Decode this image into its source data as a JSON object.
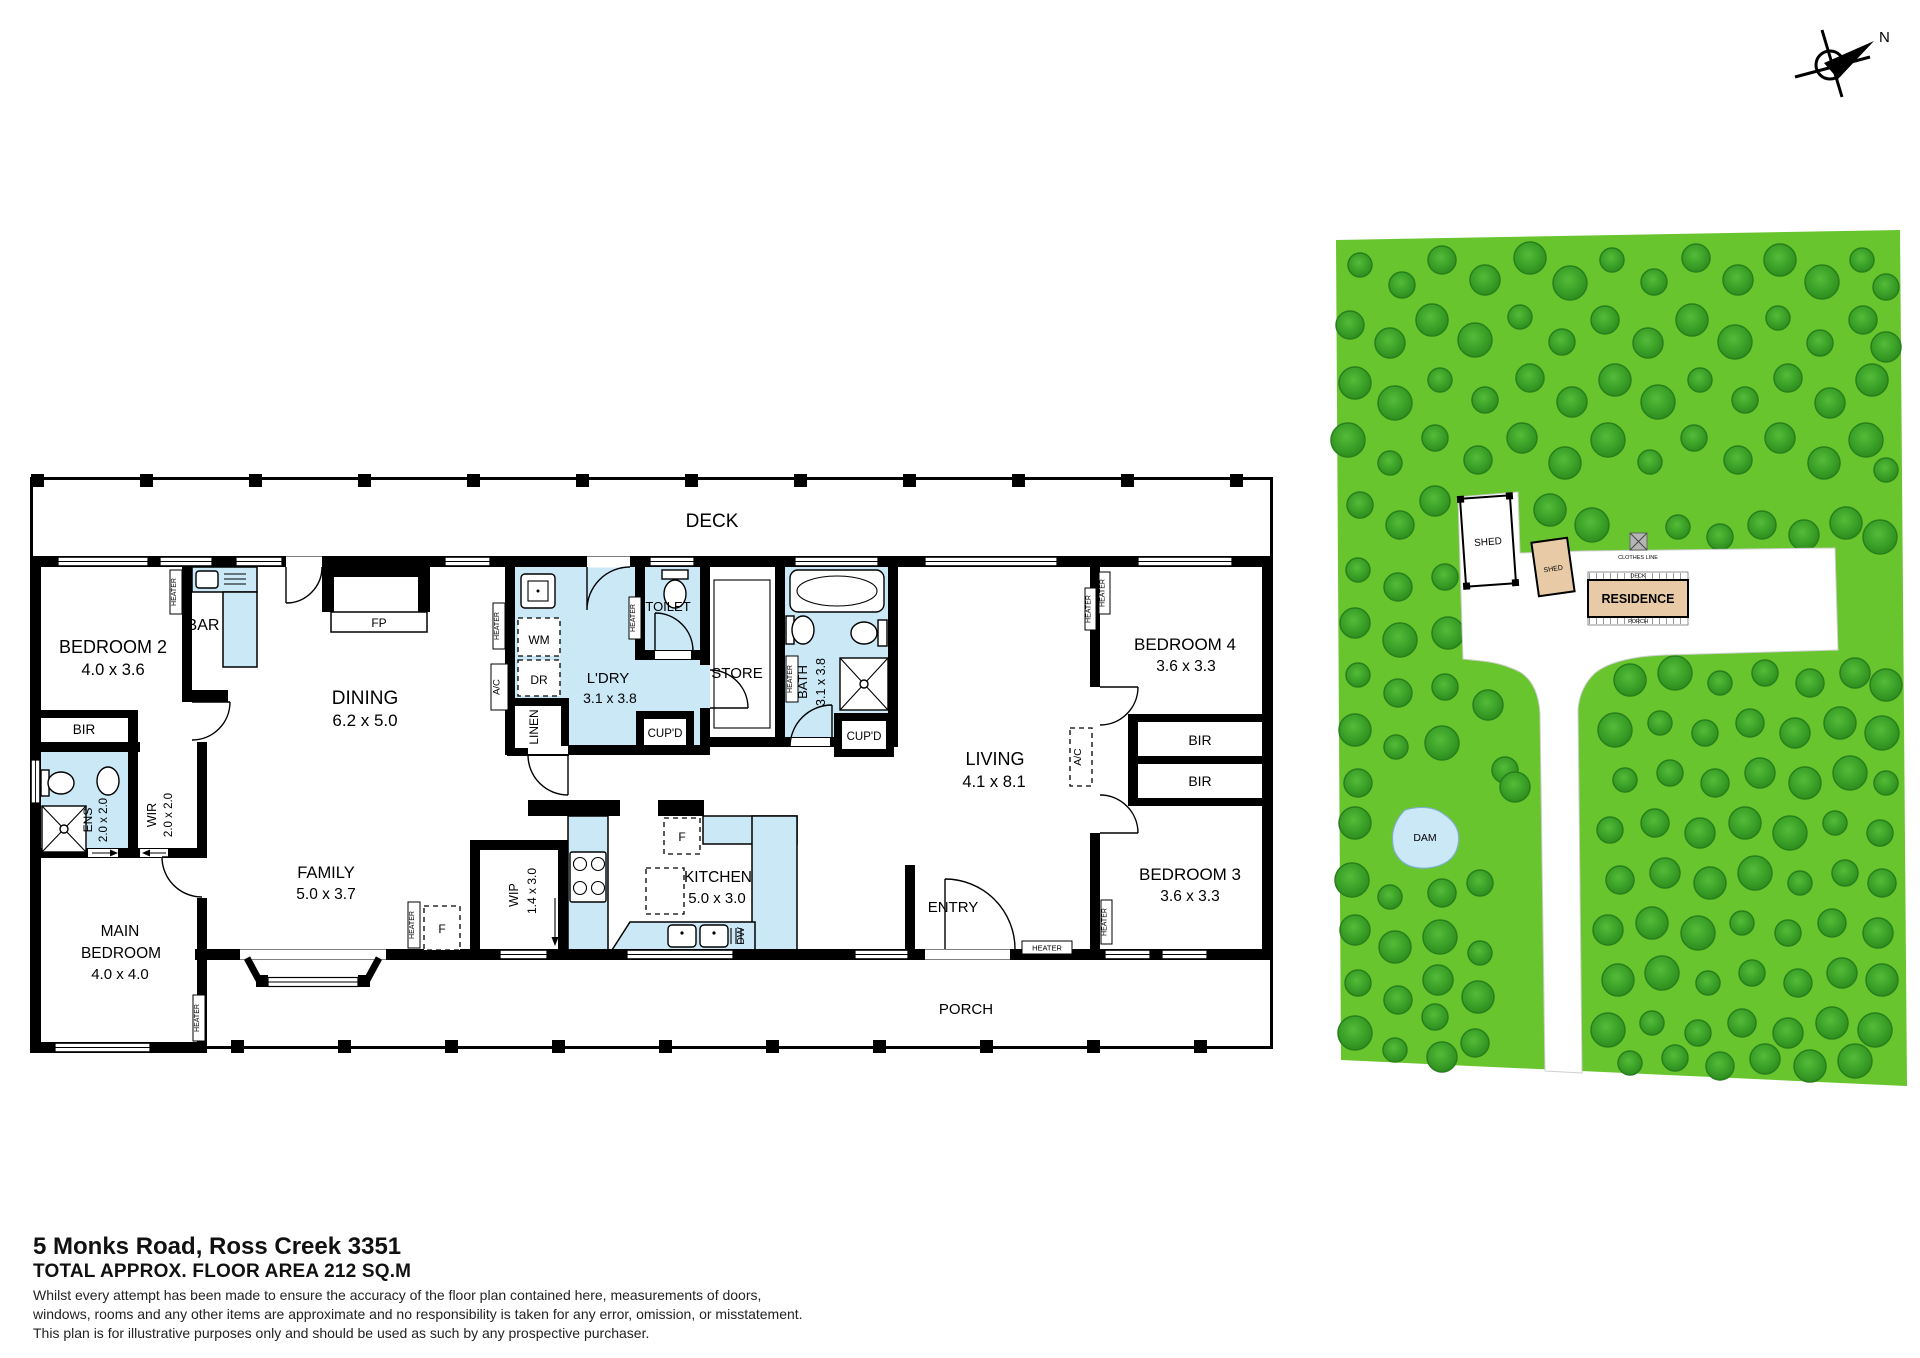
{
  "title_block": {
    "address": "5 Monks Road, Ross Creek 3351",
    "floor_area": "TOTAL APPROX. FLOOR AREA 212 SQ.M",
    "disclaimer_lines": [
      "Whilst every attempt has been made to ensure the accuracy of the floor plan contained here, measurements of doors,",
      "windows, rooms and any other items are approximate and no responsibility is taken for any error, omission, or misstatement.",
      "This plan is for illustrative purposes only and should be used as such by any prospective purchaser."
    ]
  },
  "compass": {
    "north_label": "N"
  },
  "floor_plan": {
    "deck": "DECK",
    "porch": "PORCH",
    "entry": "ENTRY",
    "bedroom2": {
      "name": "BEDROOM 2",
      "dims": "4.0 x 3.6"
    },
    "bar": "BAR",
    "dining": {
      "name": "DINING",
      "dims": "6.2 x 5.0"
    },
    "fireplace": "FP",
    "laundry": {
      "name": "L'DRY",
      "dims": "3.1 x 3.8"
    },
    "toilet": "TOILET",
    "store": "STORE",
    "bath": {
      "name": "BATH",
      "dims": "3.1 x 3.8"
    },
    "living": {
      "name": "LIVING",
      "dims": "4.1 x 8.1"
    },
    "bedroom4": {
      "name": "BEDROOM 4",
      "dims": "3.6 x 3.3"
    },
    "bedroom3": {
      "name": "BEDROOM 3",
      "dims": "3.6 x 3.3"
    },
    "main_bedroom": {
      "line1": "MAIN",
      "line2": "BEDROOM",
      "dims": "4.0 x 4.0"
    },
    "family": {
      "name": "FAMILY",
      "dims": "5.0 x 3.7"
    },
    "kitchen": {
      "name": "KITCHEN",
      "dims": "5.0 x 3.0"
    },
    "wip": {
      "name": "WIP",
      "dims": "1.4 x 3.0"
    },
    "ens": {
      "name": "ENS",
      "dims": "2.0 x 2.0"
    },
    "wir": {
      "name": "WIR",
      "dims": "2.0 x 2.0"
    },
    "bir": "BIR",
    "cupboard": "CUP'D",
    "linen": "LINEN",
    "heater": "HEATER",
    "ac": "A/C",
    "wm": "WM",
    "dr": "DR",
    "fridge": "F",
    "dw": "DW"
  },
  "site_plan": {
    "shed": "SHED",
    "residence": "RESIDENCE",
    "dam": "DAM",
    "clothes_line": "CLOTHES LINE",
    "deck": "DECK",
    "porch": "PORCH",
    "colors": {
      "grass": "#68c52e",
      "tree": "#3da42a",
      "water": "#cbe8f7",
      "building": "#e8cba6"
    },
    "trees": [
      [
        30,
        40
      ],
      [
        72,
        60
      ],
      [
        112,
        35
      ],
      [
        155,
        55
      ],
      [
        200,
        33
      ],
      [
        240,
        58
      ],
      [
        282,
        35
      ],
      [
        324,
        57
      ],
      [
        366,
        33
      ],
      [
        408,
        55
      ],
      [
        450,
        35
      ],
      [
        492,
        57
      ],
      [
        532,
        35
      ],
      [
        556,
        62
      ],
      [
        20,
        100
      ],
      [
        60,
        118
      ],
      [
        102,
        95
      ],
      [
        145,
        115
      ],
      [
        190,
        92
      ],
      [
        232,
        117
      ],
      [
        275,
        95
      ],
      [
        318,
        118
      ],
      [
        362,
        95
      ],
      [
        405,
        117
      ],
      [
        448,
        93
      ],
      [
        490,
        118
      ],
      [
        533,
        95
      ],
      [
        556,
        122
      ],
      [
        25,
        158
      ],
      [
        65,
        178
      ],
      [
        110,
        155
      ],
      [
        155,
        175
      ],
      [
        200,
        153
      ],
      [
        242,
        177
      ],
      [
        285,
        155
      ],
      [
        328,
        177
      ],
      [
        370,
        155
      ],
      [
        415,
        175
      ],
      [
        458,
        153
      ],
      [
        500,
        178
      ],
      [
        542,
        155
      ],
      [
        18,
        215
      ],
      [
        60,
        238
      ],
      [
        105,
        213
      ],
      [
        148,
        235
      ],
      [
        192,
        213
      ],
      [
        235,
        238
      ],
      [
        278,
        215
      ],
      [
        320,
        237
      ],
      [
        364,
        213
      ],
      [
        408,
        235
      ],
      [
        450,
        213
      ],
      [
        494,
        238
      ],
      [
        536,
        215
      ],
      [
        556,
        245
      ],
      [
        30,
        280
      ],
      [
        70,
        300
      ],
      [
        105,
        276
      ],
      [
        220,
        285
      ],
      [
        262,
        300
      ],
      [
        348,
        302
      ],
      [
        390,
        312
      ],
      [
        432,
        300
      ],
      [
        474,
        310
      ],
      [
        516,
        298
      ],
      [
        550,
        312
      ],
      [
        28,
        345
      ],
      [
        115,
        352
      ],
      [
        68,
        362
      ],
      [
        25,
        398
      ],
      [
        118,
        408
      ],
      [
        70,
        415
      ],
      [
        28,
        450
      ],
      [
        115,
        462
      ],
      [
        68,
        468
      ],
      [
        158,
        480
      ],
      [
        25,
        505
      ],
      [
        112,
        518
      ],
      [
        66,
        522
      ],
      [
        175,
        545
      ],
      [
        28,
        558
      ],
      [
        185,
        562
      ],
      [
        25,
        598
      ],
      [
        22,
        655
      ],
      [
        60,
        672
      ],
      [
        150,
        658
      ],
      [
        112,
        668
      ],
      [
        25,
        705
      ],
      [
        65,
        722
      ],
      [
        110,
        712
      ],
      [
        150,
        728
      ],
      [
        28,
        758
      ],
      [
        68,
        775
      ],
      [
        108,
        755
      ],
      [
        148,
        772
      ],
      [
        25,
        808
      ],
      [
        65,
        825
      ],
      [
        105,
        792
      ],
      [
        145,
        818
      ],
      [
        112,
        832
      ],
      [
        300,
        455
      ],
      [
        345,
        448
      ],
      [
        390,
        458
      ],
      [
        435,
        448
      ],
      [
        480,
        458
      ],
      [
        525,
        448
      ],
      [
        556,
        460
      ],
      [
        285,
        505
      ],
      [
        330,
        498
      ],
      [
        375,
        508
      ],
      [
        420,
        498
      ],
      [
        465,
        508
      ],
      [
        510,
        498
      ],
      [
        552,
        508
      ],
      [
        295,
        555
      ],
      [
        340,
        548
      ],
      [
        385,
        558
      ],
      [
        430,
        548
      ],
      [
        475,
        558
      ],
      [
        520,
        548
      ],
      [
        556,
        558
      ],
      [
        280,
        605
      ],
      [
        325,
        598
      ],
      [
        370,
        608
      ],
      [
        415,
        598
      ],
      [
        460,
        608
      ],
      [
        505,
        598
      ],
      [
        550,
        608
      ],
      [
        290,
        655
      ],
      [
        335,
        648
      ],
      [
        380,
        658
      ],
      [
        425,
        648
      ],
      [
        470,
        658
      ],
      [
        515,
        648
      ],
      [
        552,
        658
      ],
      [
        278,
        705
      ],
      [
        322,
        698
      ],
      [
        368,
        708
      ],
      [
        412,
        698
      ],
      [
        458,
        708
      ],
      [
        502,
        698
      ],
      [
        548,
        708
      ],
      [
        288,
        755
      ],
      [
        332,
        748
      ],
      [
        378,
        758
      ],
      [
        422,
        748
      ],
      [
        468,
        758
      ],
      [
        512,
        748
      ],
      [
        552,
        755
      ],
      [
        278,
        805
      ],
      [
        322,
        798
      ],
      [
        368,
        808
      ],
      [
        412,
        798
      ],
      [
        458,
        808
      ],
      [
        502,
        798
      ],
      [
        545,
        805
      ],
      [
        300,
        838
      ],
      [
        345,
        833
      ],
      [
        390,
        841
      ],
      [
        435,
        834
      ],
      [
        480,
        841
      ],
      [
        525,
        836
      ]
    ]
  }
}
